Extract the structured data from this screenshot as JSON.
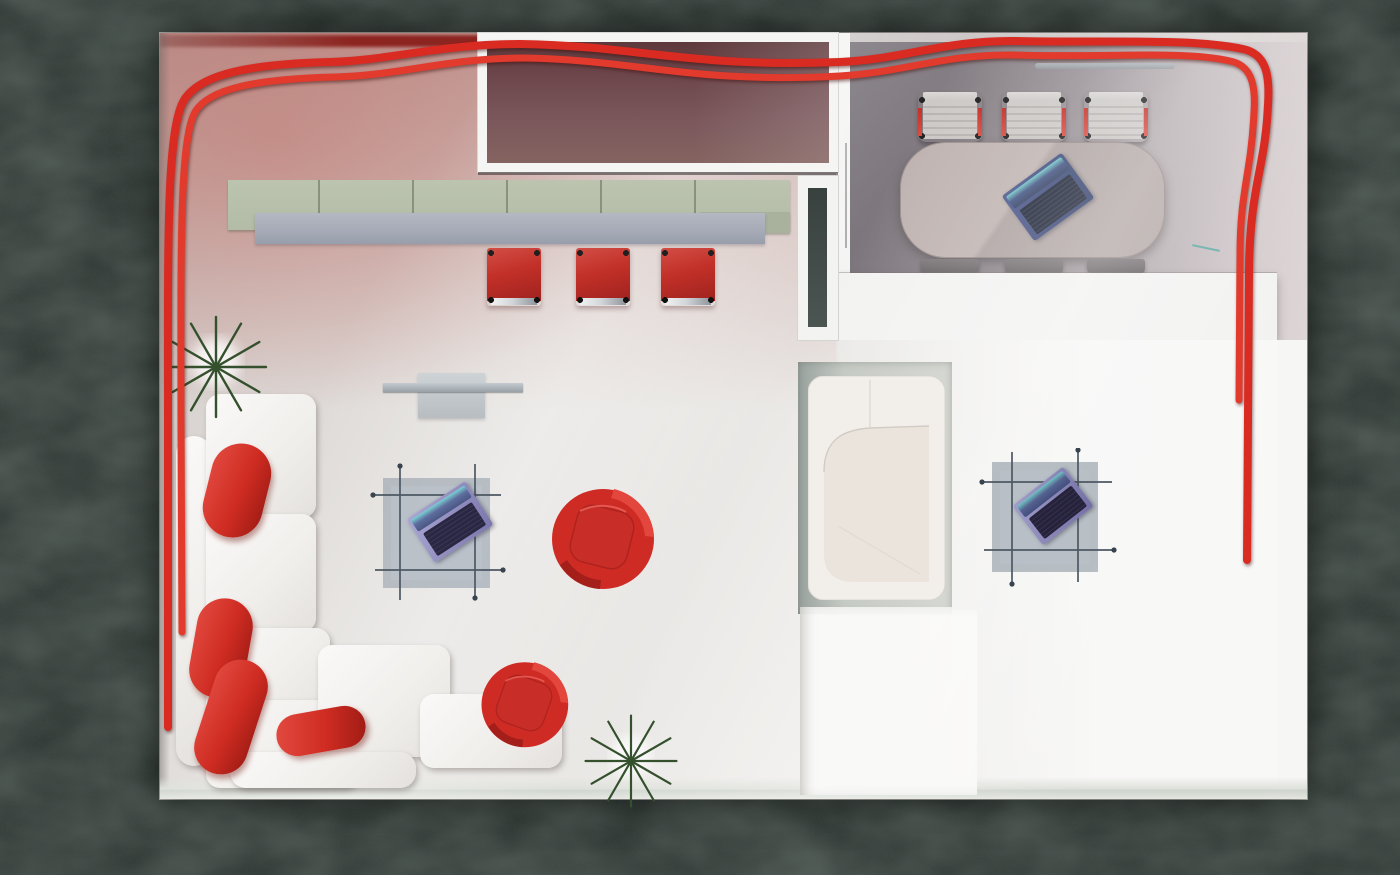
{
  "scene": {
    "description": "Top-down 3D render of an exhibition-stand style office floor plan on a dark plaster background",
    "background": {
      "color": "#29322e",
      "texture": "dark-plaster"
    },
    "floor": {
      "base_color": "#e7e5e2",
      "warm_glow": "#b07a74",
      "bottom_edge": "#cfd4cd"
    },
    "red_tube": {
      "color": "#dc2c22",
      "path": "runs along top edge, down left wall and down right wall"
    },
    "rooms": [
      {
        "name": "showroom-lounge",
        "features": [
          "maroon display box",
          "sage wall shelf",
          "gray bar counter",
          "three red bar stools",
          "wall console",
          "glass coffee table with laptop",
          "two red swivel chairs",
          "L-shaped white sofa with red bolster cushions",
          "two starburst plants"
        ]
      },
      {
        "name": "conference-room",
        "floor_color": "#8b8389",
        "features": [
          "rounded conference table",
          "laptop",
          "three chairs top",
          "three chairs bottom",
          "wall rail",
          "white wall band"
        ]
      },
      {
        "name": "lounge-booth-area",
        "features": [
          "white booth sofa on gray mat",
          "glass side table with laptop",
          "bright floor square"
        ]
      }
    ],
    "colors": {
      "accent_red": "#c8302a",
      "maroon_panel": "#735257",
      "sage_shelf": "#b7c0ab",
      "counter_gray": "#a9aeba",
      "conference_table": "#b5a9a7",
      "sofa_white": "#f3f0ed",
      "plant_green": "#375230",
      "laptop_navy": "#344067",
      "laptop_purple": "#8f8cc0",
      "teal_detail": "#4fa6a0"
    },
    "counts": {
      "laptops": 3,
      "red_swivel_chairs": 2,
      "bar_stools": 3,
      "conference_chairs": 6,
      "plants": 2,
      "sofas": 2,
      "glass_tables": 2
    }
  }
}
